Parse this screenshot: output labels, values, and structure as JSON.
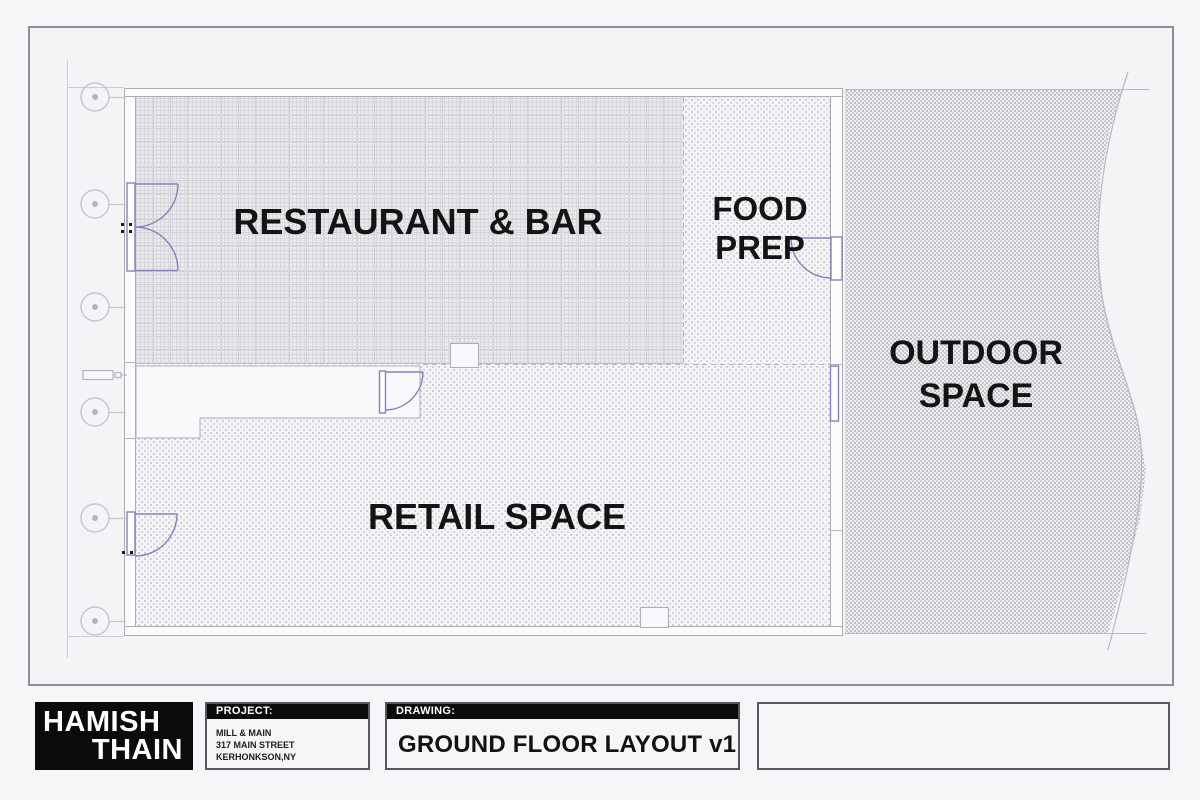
{
  "rooms": {
    "restaurant": {
      "label": "RESTAURANT & BAR"
    },
    "food_prep": {
      "line1": "FOOD",
      "line2": "PREP"
    },
    "outdoor": {
      "line1": "OUTDOOR",
      "line2": "SPACE"
    },
    "retail": {
      "label": "RETAIL SPACE"
    }
  },
  "title_block": {
    "firm": {
      "line1": "HAMISH",
      "line2": "THAIN"
    },
    "project": {
      "header": "PROJECT:",
      "lines": [
        "MILL & MAIN",
        "317 MAIN STREET",
        "KERHONKSON,NY"
      ]
    },
    "drawing": {
      "header": "DRAWING:",
      "title": "GROUND FLOOR LAYOUT v1"
    }
  },
  "colors": {
    "door_accent": "#8682bc",
    "wall_line": "#abadb2",
    "grid_marker": "#c6c8cc",
    "ink": "#141414"
  }
}
